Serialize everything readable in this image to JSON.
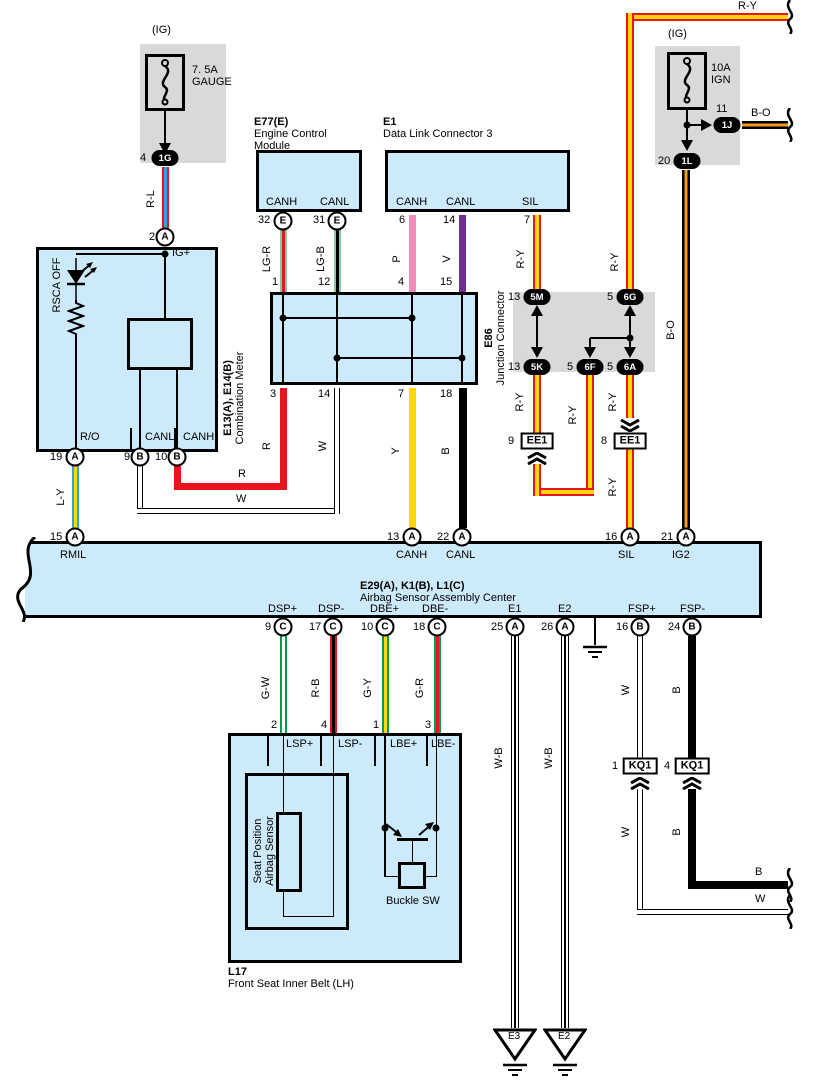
{
  "palette": {
    "box_fill": "#cdeafb",
    "gray_box": "#d9d9d9",
    "red": "#e8141e",
    "yellow": "#ffd60a",
    "blue": "#2ba6de",
    "orange": "#f49b20",
    "pink": "#f08cb8",
    "violet": "#6f2c91",
    "light_green": "#8bc8a0",
    "green": "#00a04a",
    "black": "#000000",
    "white": "#ffffff"
  },
  "fuse_gauge": {
    "ig": "(IG)",
    "amp": "7. 5A",
    "name": "GAUGE",
    "pin": "4",
    "terminal": "1G"
  },
  "fuse_ign": {
    "ig": "(IG)",
    "amp": "10A",
    "name": "IGN",
    "pin_1j": "11",
    "terminal_1j": "1J",
    "pin_1l": "20",
    "terminal_1l": "1L"
  },
  "ecm": {
    "id": "E77(E)",
    "name1": "Engine Control",
    "name2": "Module",
    "canh": "CANH",
    "canl": "CANL",
    "pin_canh": "32",
    "pin_canl": "31"
  },
  "dlc3": {
    "id": "E1",
    "name": "Data Link Connector 3",
    "canh": "CANH",
    "canl": "CANL",
    "sil": "SIL",
    "pin_canh": "6",
    "pin_canl": "14",
    "pin_sil": "7"
  },
  "meter": {
    "id": "E13(A), E14(B)",
    "name": "Combination Meter",
    "rsca": "RSCA OFF",
    "ig_plus": "IG+",
    "pin_top": "2",
    "ro": "R/O",
    "canl": "CANL",
    "canh": "CANH",
    "pin_ro": "19",
    "pin_canl": "9",
    "pin_canh": "10"
  },
  "e86": {
    "id": "E86",
    "name": "Junction Connector",
    "pin_t1": "1",
    "pin_t2": "12",
    "pin_t3": "4",
    "pin_t4": "15",
    "pin_b1": "3",
    "pin_b2": "14",
    "pin_b3": "7",
    "pin_b4": "18"
  },
  "jb": {
    "no_5m": "13",
    "id_5m": "5M",
    "no_6g": "5",
    "id_6g": "6G",
    "no_5k": "13",
    "id_5k": "5K",
    "no_6f": "5",
    "id_6f": "6F",
    "no_6a": "5",
    "id_6a": "6A"
  },
  "ee1": {
    "label": "EE1",
    "no_left": "9",
    "no_right": "8"
  },
  "kq1": {
    "label": "KQ1",
    "no_left": "1",
    "no_right": "4"
  },
  "airbag": {
    "id": "E29(A), K1(B), L1(C)",
    "name": "Airbag Sensor Assembly Center",
    "rmil": "RMIL",
    "canh": "CANH",
    "canl": "CANL",
    "sil": "SIL",
    "ig2": "IG2",
    "no_rmil": "15",
    "no_canh": "13",
    "no_canl": "22",
    "no_sil": "16",
    "no_ig2": "21",
    "dsp_p": "DSP+",
    "dsp_m": "DSP-",
    "dbe_p": "DBE+",
    "dbe_m": "DBE-",
    "e1": "E1",
    "e2": "E2",
    "fsp_p": "FSP+",
    "fsp_m": "FSP-",
    "no_dsp_p": "9",
    "no_dsp_m": "17",
    "no_dbe_p": "10",
    "no_dbe_m": "18",
    "no_e1": "25",
    "no_e2": "26",
    "no_fsp_p": "16",
    "no_fsp_m": "24"
  },
  "l17": {
    "id": "L17",
    "name": "Front Seat Inner Belt (LH)",
    "lsp_p": "LSP+",
    "lsp_m": "LSP-",
    "lbe_p": "LBE+",
    "lbe_m": "LBE-",
    "no_lsp_p": "2",
    "no_lsp_m": "4",
    "no_lbe_p": "1",
    "no_lbe_m": "3",
    "sensor1": "Seat Position",
    "sensor2": "Airbag Sensor",
    "buckle": "Buckle SW"
  },
  "grounds": {
    "e3": "E3",
    "e2": "E2"
  },
  "letters": {
    "a": "A",
    "b": "B",
    "c": "C",
    "e": "E"
  },
  "wires": {
    "rl": "R-L",
    "ly": "L-Y",
    "r": "R",
    "w": "W",
    "y": "Y",
    "b": "B",
    "ry": "R-Y",
    "bo": "B-O",
    "lgr": "LG-R",
    "lgb": "LG-B",
    "p": "P",
    "v": "V",
    "gw": "G-W",
    "rb": "R-B",
    "gy": "G-Y",
    "gr": "G-R",
    "wb": "W-B"
  }
}
